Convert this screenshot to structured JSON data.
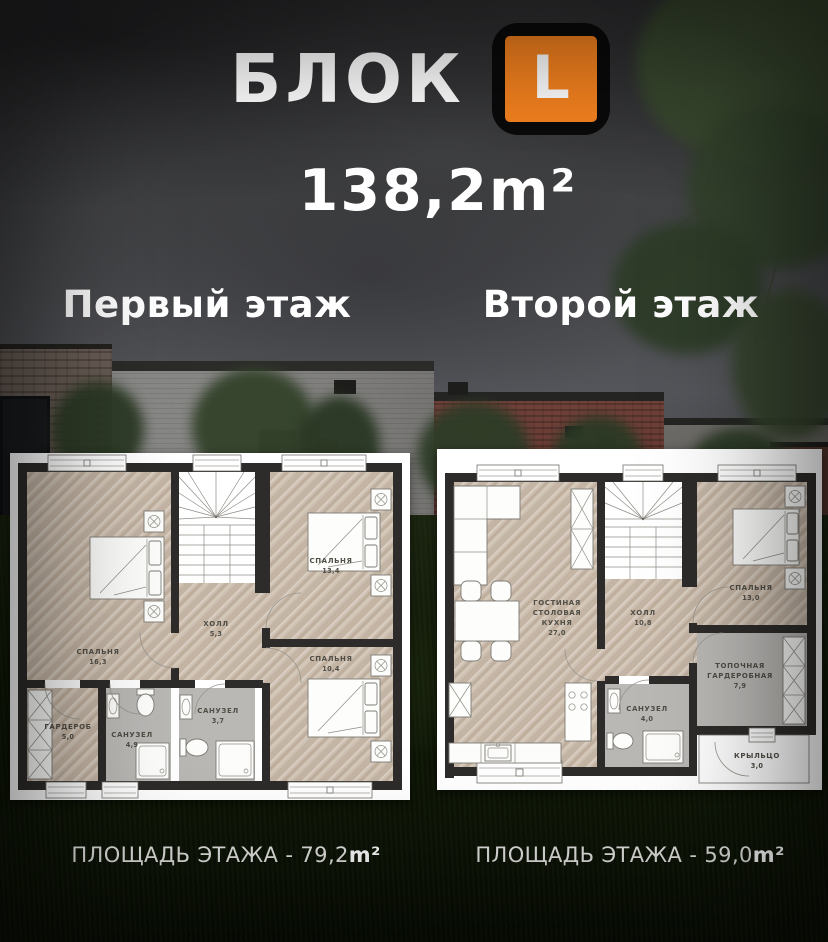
{
  "header": {
    "block_label": "БЛОК",
    "logo_letter": "L",
    "total_area": "138,2m²"
  },
  "floors": [
    {
      "title": "Первый этаж",
      "footer_label": "ПЛОЩАДЬ ЭТАЖА - 79,2",
      "footer_unit": "m²",
      "rooms": [
        {
          "lines": [
            "СПАЛЬНЯ"
          ],
          "area": "16,3"
        },
        {
          "lines": [
            "ХОЛЛ"
          ],
          "area": "5,3"
        },
        {
          "lines": [
            "СПАЛЬНЯ"
          ],
          "area": "13,4"
        },
        {
          "lines": [
            "СПАЛЬНЯ"
          ],
          "area": "10,4"
        },
        {
          "lines": [
            "ГАРДЕРОБ"
          ],
          "area": "5,0"
        },
        {
          "lines": [
            "САНУЗЕЛ"
          ],
          "area": "4,9"
        },
        {
          "lines": [
            "САНУЗЕЛ"
          ],
          "area": "3,7"
        }
      ]
    },
    {
      "title": "Второй этаж",
      "footer_label": "ПЛОЩАДЬ ЭТАЖА - 59,0",
      "footer_unit": "m²",
      "rooms": [
        {
          "lines": [
            "ГОСТИНАЯ",
            "СТОЛОВАЯ",
            "КУХНЯ"
          ],
          "area": "27,0"
        },
        {
          "lines": [
            "ХОЛЛ"
          ],
          "area": "10,8"
        },
        {
          "lines": [
            "СПАЛЬНЯ"
          ],
          "area": "13,0"
        },
        {
          "lines": [
            "ТОПОЧНАЯ",
            "ГАРДЕРОБНАЯ"
          ],
          "area": "7,9"
        },
        {
          "lines": [
            "САНУЗЕЛ"
          ],
          "area": "4,0"
        },
        {
          "lines": [
            "КРЫЛЬЦО"
          ],
          "area": "3,0"
        }
      ]
    }
  ],
  "colors": {
    "accent_orange": "#F5821F",
    "logo_bg": "#0A0A0A",
    "title_text": "#FFFFFF",
    "wall": "#2D2C2A",
    "wood_floor": "#CDC0B2",
    "wet_floor": "#B9B8B5"
  }
}
